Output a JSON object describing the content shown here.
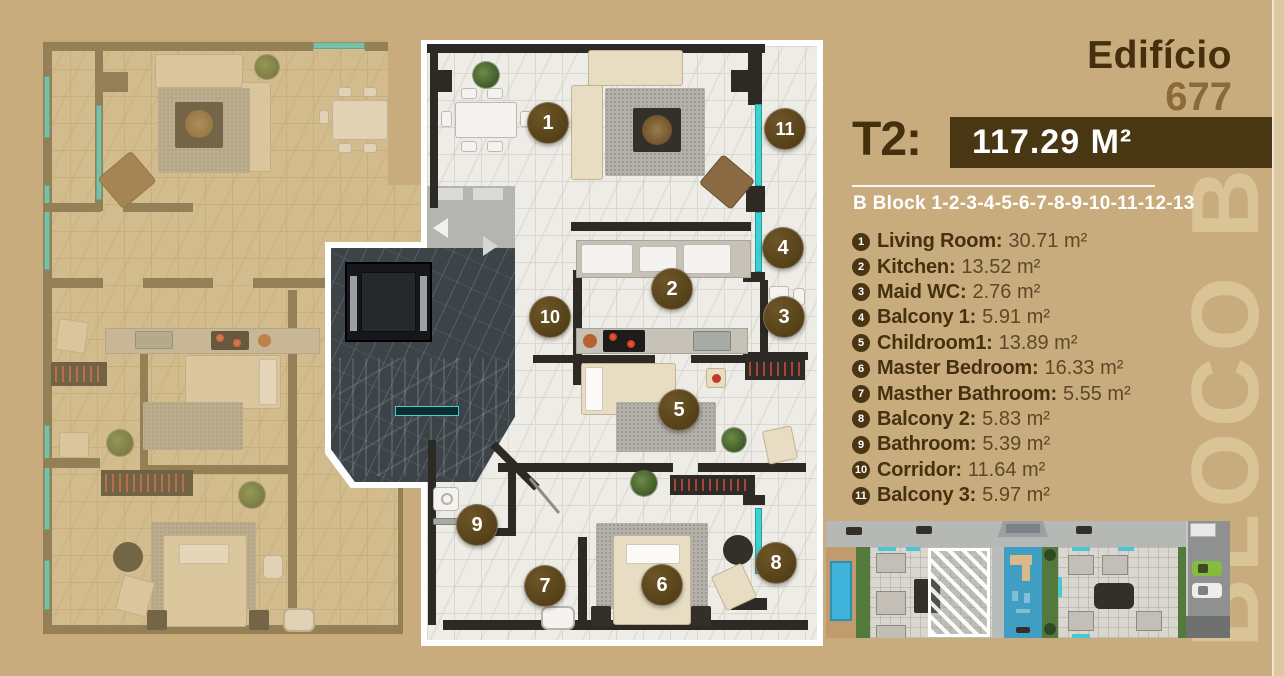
{
  "brand": {
    "title": "Edifício",
    "number": "677"
  },
  "unit": {
    "type": "T2:",
    "area": "117.29 M²"
  },
  "block_line": "B Block 1-2-3-4-5-6-7-8-9-10-11-12-13",
  "watermark": "BLOCO B",
  "rooms": [
    {
      "num": "1",
      "label": "Living Room:",
      "area": "30.71 m²"
    },
    {
      "num": "2",
      "label": "Kitchen:",
      "area": "13.52 m²"
    },
    {
      "num": "3",
      "label": "Maid WC:",
      "area": "2.76 m²"
    },
    {
      "num": "4",
      "label": "Balcony 1:",
      "area": "5.91 m²"
    },
    {
      "num": "5",
      "label": "Childroom1:",
      "area": "13.89 m²"
    },
    {
      "num": "6",
      "label": "Master Bedroom:",
      "area": "16.33 m²"
    },
    {
      "num": "7",
      "label": "Masther Bathroom:",
      "area": "5.55 m²"
    },
    {
      "num": "8",
      "label": "Balcony 2:",
      "area": "5.83 m²"
    },
    {
      "num": "9",
      "label": "Bathroom:",
      "area": "5.39 m²"
    },
    {
      "num": "10",
      "label": "Corridor:",
      "area": "11.64 m²"
    },
    {
      "num": "11",
      "label": "Balcony 3:",
      "area": "5.97 m²"
    }
  ],
  "plan_markers": [
    {
      "n": "1"
    },
    {
      "n": "2"
    },
    {
      "n": "3"
    },
    {
      "n": "4"
    },
    {
      "n": "5"
    },
    {
      "n": "6"
    },
    {
      "n": "7"
    },
    {
      "n": "8"
    },
    {
      "n": "9"
    },
    {
      "n": "10"
    },
    {
      "n": "11"
    }
  ],
  "colors": {
    "background_tan": "#c9ac7e",
    "brand_dark_brown": "#45300d",
    "brand_light_brown": "#8a6a38",
    "area_box_brown": "#493613",
    "marker_brown": "#5c4a21",
    "accent_teal": "#3fd0d0",
    "highlight_outline": "#ffffff",
    "watermark_cream": "#d9c397"
  }
}
